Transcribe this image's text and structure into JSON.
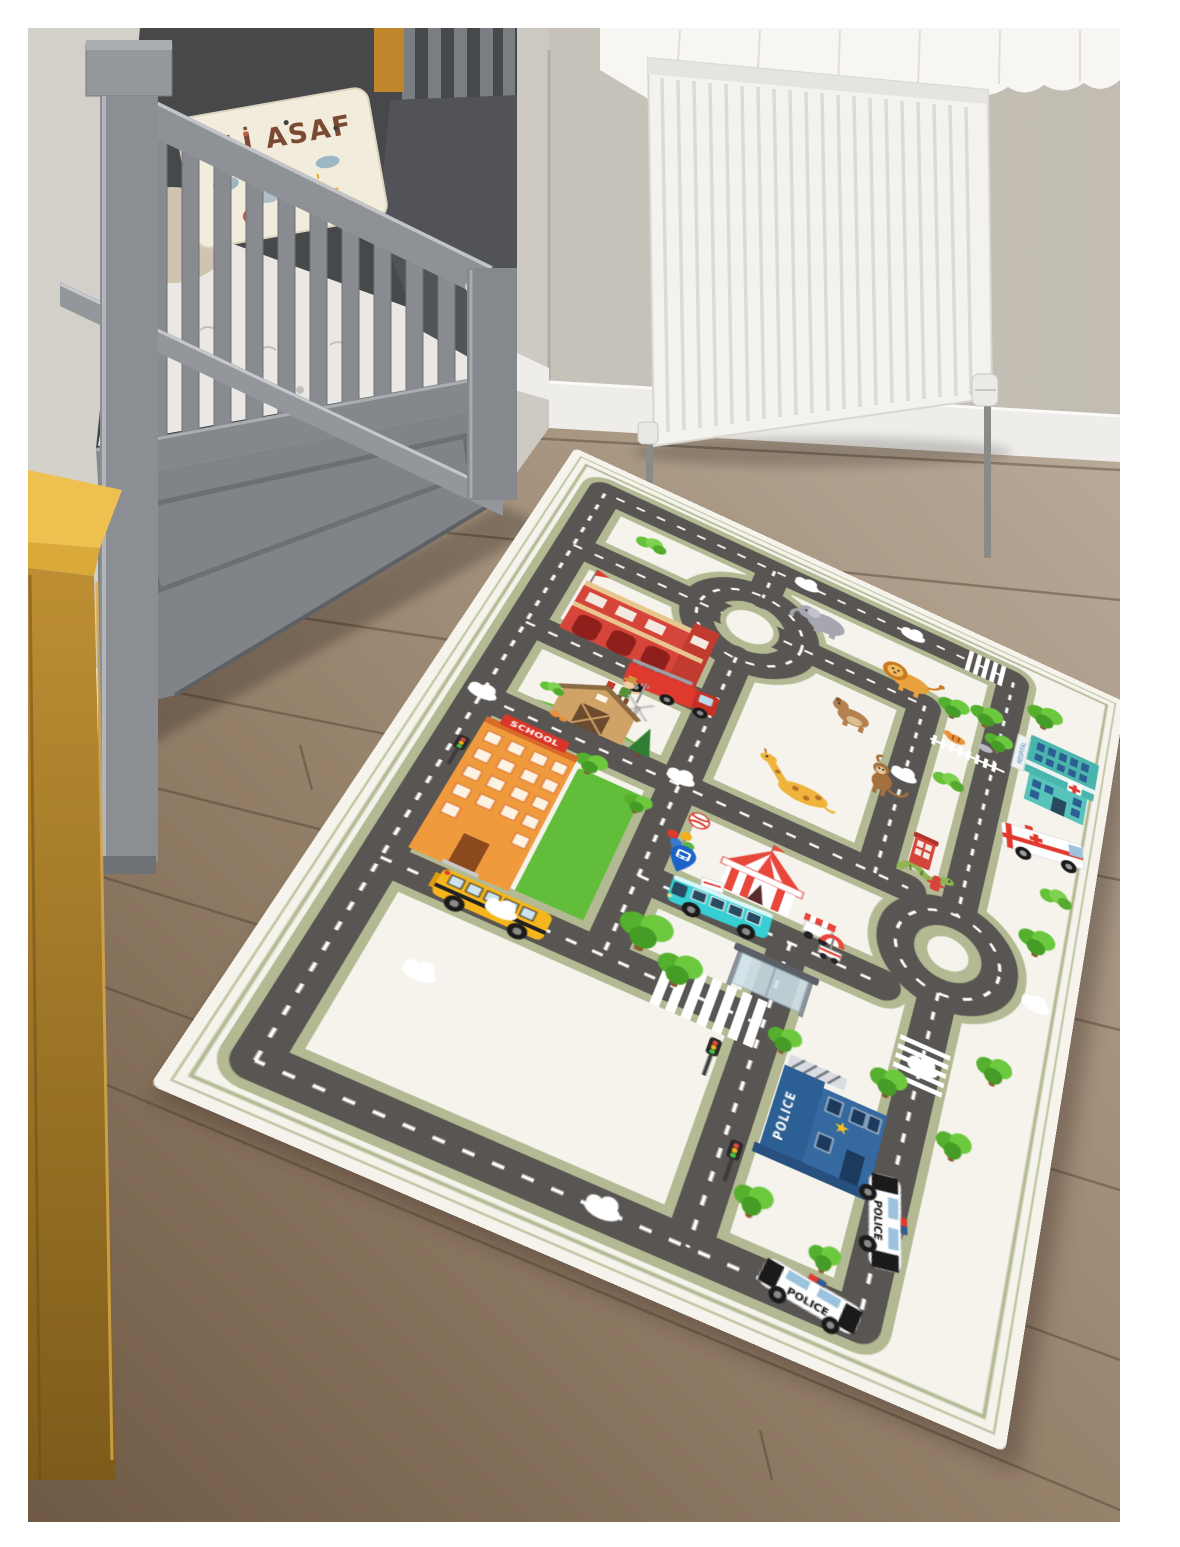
{
  "scene": {
    "type": "nursery-room-photo",
    "description": "Photo of a children's city-road play rug laid on a wooden floor in a nursery, beside a gray crib with a name pillow, a white radiator on the wall and a yellow dresser at the left edge."
  },
  "room": {
    "pillow_text": "ALİ ASAF",
    "colors": {
      "wall": "#cdc9c2",
      "curtain": "#f7f6f3",
      "radiator": "#f3f2ee",
      "crib": "#8b8e92",
      "dresser": "#c89737",
      "floor": "#8a755e",
      "skirting": "#efede9"
    },
    "objects": [
      "crib",
      "name-pillow",
      "mattress",
      "crib-drawer",
      "radiator",
      "curtain",
      "skirting-board",
      "wooden-floor",
      "yellow-dresser"
    ]
  },
  "rug": {
    "school_sign": "SCHOOL",
    "police_sign": "POLICE",
    "police_car_text": "POLICE",
    "police_car_text2": "POLICE",
    "hospital_sign": "HOSPITAL",
    "colors": {
      "background": "#f5f3ec",
      "road": "#595552",
      "road_edge": "#b2b993",
      "road_dash": "#ffffff",
      "grass": "#62bd3a",
      "fire_station": "#d6453a",
      "hospital": "#4ab5ad",
      "police_station": "#31659c",
      "school": "#f09a3e",
      "school_bus": "#f5b51c",
      "city_bus": "#37cfd4"
    },
    "landmarks": [
      "roundabout",
      "second-roundabout",
      "fire-station",
      "fire-truck",
      "zoo-park",
      "elephant",
      "lion",
      "bear",
      "monkey",
      "giraffe",
      "snake",
      "hospital",
      "ambulance",
      "farm-barn",
      "windmill",
      "farmer",
      "circus-tent",
      "food-cart",
      "umbrella-cart",
      "ticket-paper",
      "phone-booth",
      "fire-hydrant",
      "ball",
      "balloons",
      "school",
      "school-yard",
      "school-bus",
      "city-bus",
      "bus-shelter",
      "bus-stop-pin",
      "zebra-crossing",
      "traffic-light",
      "police-station",
      "police-car",
      "trees",
      "bushes",
      "printed-clouds"
    ]
  }
}
